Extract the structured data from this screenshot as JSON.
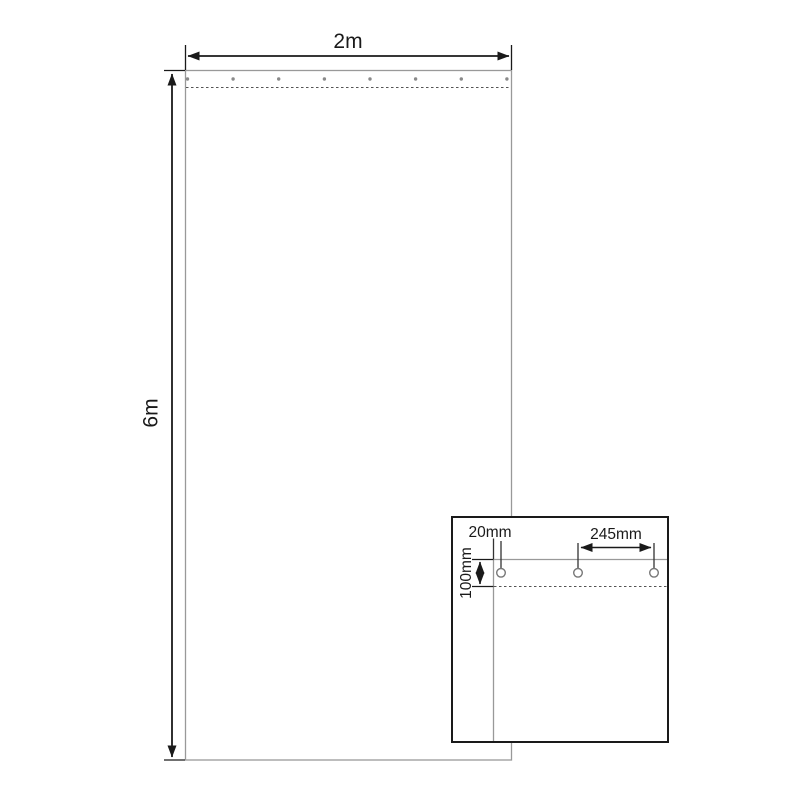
{
  "diagram": {
    "description": "Technical dimension drawing of a 2m x 6m sheet with eyelets along the top hem and a magnified corner detail view",
    "main_view": {
      "width_label": "2m",
      "height_label": "6m",
      "eyelet_count": 8
    },
    "detail_view": {
      "edge_offset_label": "20mm",
      "eyelet_spacing_label": "245mm",
      "hem_depth_label": "100mm",
      "eyelet_count": 3
    },
    "colors": {
      "sheet_outline": "#999999",
      "dimension_lines": "#1a1a1a",
      "hem_dash": "#555555",
      "eyelet_dot": "#8a8a8a",
      "eyelet_ring": "#777777",
      "background": "#ffffff"
    }
  }
}
